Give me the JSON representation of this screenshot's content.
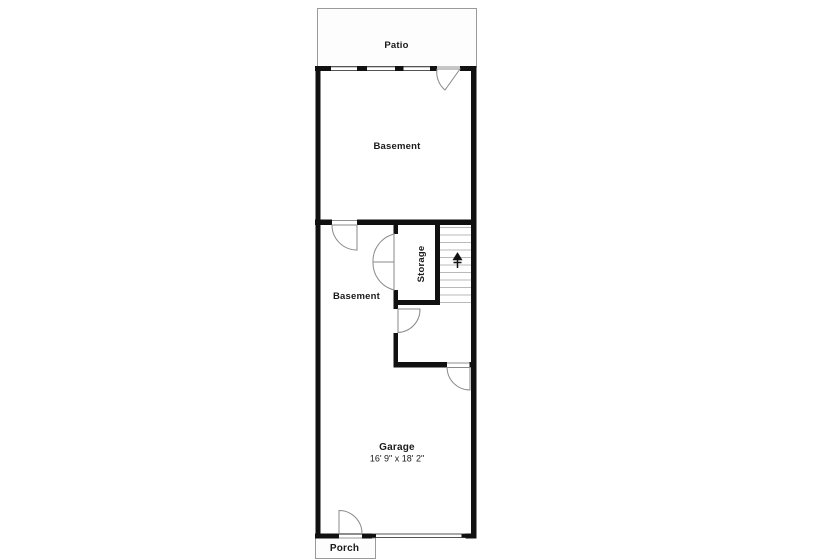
{
  "plan": {
    "type": "basement-floor-plan",
    "colors": {
      "background": "#ffffff",
      "walls": "#111111",
      "thin_outline": "#9a9a9a",
      "stair_treads": "#b9b9b9",
      "text": "#1a1a1a"
    },
    "rooms": {
      "patio": {
        "label": "Patio"
      },
      "basement_upper": {
        "label": "Basement"
      },
      "basement_lower": {
        "label": "Basement"
      },
      "storage": {
        "label": "Storage"
      },
      "garage": {
        "label": "Garage",
        "dimensions": "16' 9\" x 18' 2\""
      },
      "porch": {
        "label": "Porch"
      }
    },
    "features": {
      "staircase": "stairs-up",
      "doors": 7,
      "windows": 3
    }
  }
}
